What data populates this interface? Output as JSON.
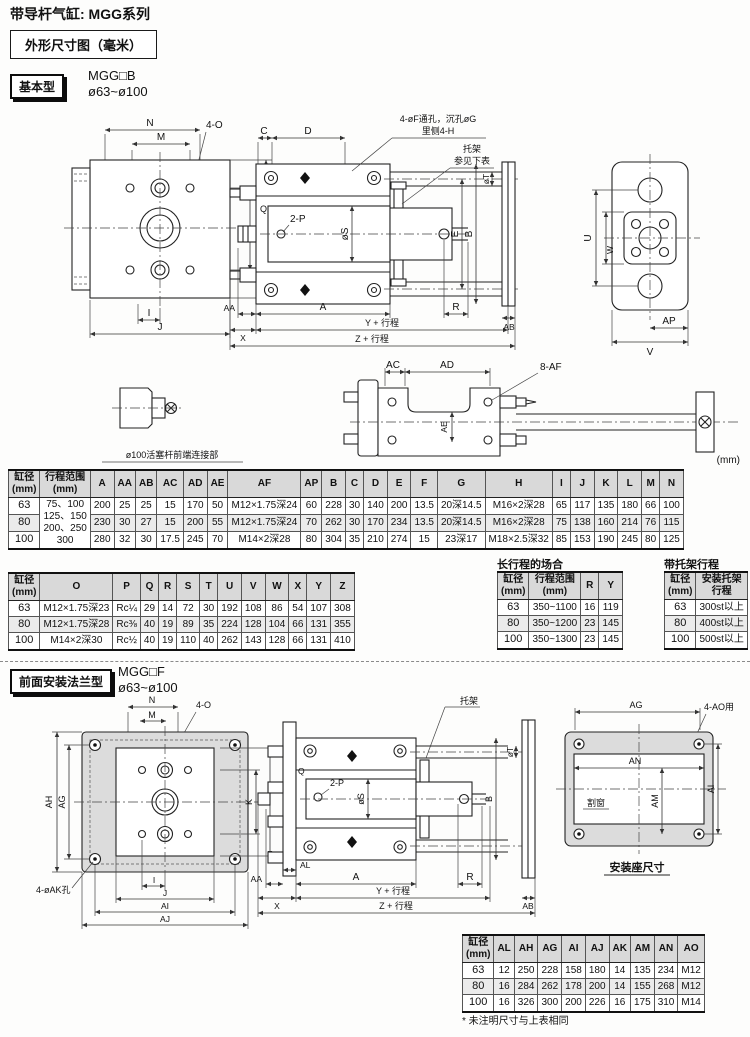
{
  "page": {
    "title": "带导杆气缸: MGG系列",
    "dim_box_label": "外形尺寸图（毫米）",
    "unit_note": "(mm)"
  },
  "sections": {
    "basic": {
      "tag": "基本型",
      "model": "MGG□B",
      "bore_range": "ø63~ø100"
    },
    "flange": {
      "tag": "前面安装法兰型",
      "model": "MGG□F",
      "bore_range": "ø63~ø100"
    }
  },
  "drawing_basic": {
    "callout_holes_1": "4-øF通孔，沉孔øG",
    "callout_holes_2": "里侧4-H",
    "callout_bracket_1": "托架",
    "callout_bracket_2": "参见下表",
    "dim_n": "N",
    "dim_m": "M",
    "dim_4o": "4-O",
    "dim_k": "K",
    "dim_l": "L",
    "dim_i": "I",
    "dim_j": "J",
    "dim_c": "C",
    "dim_d": "D",
    "dim_q": "Q",
    "dim_2p": "2-P",
    "dim_os": "øS",
    "dim_e": "E",
    "dim_b": "B",
    "dim_ot": "øT",
    "dim_aa": "AA",
    "dim_x": "X",
    "dim_a": "A",
    "dim_r": "R",
    "dim_ab": "AB",
    "dim_y_stroke": "Y + 行程",
    "dim_z_stroke": "Z + 行程",
    "dim_u": "U",
    "dim_w": "W",
    "dim_ap": "AP",
    "dim_v": "V"
  },
  "drawing_rod_end": {
    "caption": "ø100活塞杆前端连接部",
    "dim_ac": "AC",
    "dim_ad": "AD",
    "dim_8af": "8-AF",
    "dim_ae": "AE"
  },
  "drawing_flange": {
    "callout_bracket": "托架",
    "dim_n": "N",
    "dim_m": "M",
    "dim_4o": "4-O",
    "dim_ah": "AH",
    "dim_ag": "AG",
    "dim_k": "K",
    "dim_l": "L",
    "dim_4ak": "4-øAK孔",
    "dim_i": "I",
    "dim_j": "J",
    "dim_ai": "AI",
    "dim_aj": "AJ",
    "dim_q": "Q",
    "dim_2p": "2-P",
    "dim_os": "øS",
    "dim_ot": "øT",
    "dim_b": "B",
    "dim_al": "AL",
    "dim_aa": "AA",
    "dim_x": "X",
    "dim_a": "A",
    "dim_r": "R",
    "dim_ab": "AB",
    "dim_y_stroke": "Y + 行程",
    "dim_z_stroke": "Z + 行程"
  },
  "drawing_mount_base": {
    "dim_ag": "AG",
    "dim_4ao": "4-AO用",
    "dim_an": "AN",
    "dim_am": "AM",
    "dim_ai": "AI",
    "window_label": "割窗",
    "caption": "安装座尺寸"
  },
  "tables": {
    "basic_dims_1": {
      "headers": [
        "缸径\n(mm)",
        "行程范围\n(mm)",
        "A",
        "AA",
        "AB",
        "AC",
        "AD",
        "AE",
        "AF",
        "AP",
        "B",
        "C",
        "D",
        "E",
        "F",
        "G",
        "H",
        "I",
        "J",
        "K",
        "L",
        "M",
        "N"
      ],
      "rows": [
        [
          "63",
          {
            "t": "75、100\n125、150\n200、250\n300",
            "rs": 3
          },
          "200",
          "25",
          "25",
          "15",
          "170",
          "50",
          "M12×1.75深24",
          "60",
          "228",
          "30",
          "140",
          "200",
          "13.5",
          "20深14.5",
          "M16×2深28",
          "65",
          "117",
          "135",
          "180",
          "66",
          "100"
        ],
        [
          "80",
          "230",
          "30",
          "27",
          "15",
          "200",
          "55",
          "M12×1.75深24",
          "70",
          "262",
          "30",
          "170",
          "234",
          "13.5",
          "20深14.5",
          "M16×2深28",
          "75",
          "138",
          "160",
          "214",
          "76",
          "115"
        ],
        [
          "100",
          "280",
          "32",
          "30",
          "17.5",
          "245",
          "70",
          "M14×2深28",
          "80",
          "304",
          "35",
          "210",
          "274",
          "15",
          "23深17",
          "M18×2.5深32",
          "85",
          "153",
          "190",
          "245",
          "80",
          "125"
        ]
      ]
    },
    "basic_dims_2": {
      "headers": [
        "缸径\n(mm)",
        "O",
        "P",
        "Q",
        "R",
        "S",
        "T",
        "U",
        "V",
        "W",
        "X",
        "Y",
        "Z"
      ],
      "rows": [
        [
          "63",
          "M12×1.75深23",
          "Rc¼",
          "29",
          "14",
          "72",
          "30",
          "192",
          "108",
          "86",
          "54",
          "107",
          "308"
        ],
        [
          "80",
          "M12×1.75深28",
          "Rc⅜",
          "40",
          "19",
          "89",
          "35",
          "224",
          "128",
          "104",
          "66",
          "131",
          "355"
        ],
        [
          "100",
          "M14×2深30",
          "Rc½",
          "40",
          "19",
          "110",
          "40",
          "262",
          "143",
          "128",
          "66",
          "131",
          "410"
        ]
      ]
    },
    "long_stroke": {
      "title": "长行程的场合",
      "headers": [
        "缸径\n(mm)",
        "行程范围\n(mm)",
        "R",
        "Y"
      ],
      "rows": [
        [
          "63",
          "350~1100",
          "16",
          "119"
        ],
        [
          "80",
          "350~1200",
          "23",
          "145"
        ],
        [
          "100",
          "350~1300",
          "23",
          "145"
        ]
      ]
    },
    "bracket_stroke": {
      "title": "带托架行程",
      "headers": [
        "缸径\n(mm)",
        "安装托架\n行程"
      ],
      "rows": [
        [
          "63",
          "300st以上"
        ],
        [
          "80",
          "400st以上"
        ],
        [
          "100",
          "500st以上"
        ]
      ]
    },
    "flange_dims": {
      "headers": [
        "缸径\n(mm)",
        "AL",
        "AH",
        "AG",
        "AI",
        "AJ",
        "AK",
        "AM",
        "AN",
        "AO"
      ],
      "rows": [
        [
          "63",
          "12",
          "250",
          "228",
          "158",
          "180",
          "14",
          "135",
          "234",
          "M12"
        ],
        [
          "80",
          "16",
          "284",
          "262",
          "178",
          "200",
          "14",
          "155",
          "268",
          "M12"
        ],
        [
          "100",
          "16",
          "326",
          "300",
          "200",
          "226",
          "16",
          "175",
          "310",
          "M14"
        ]
      ],
      "footnote": "* 未注明尺寸与上表相同"
    }
  }
}
